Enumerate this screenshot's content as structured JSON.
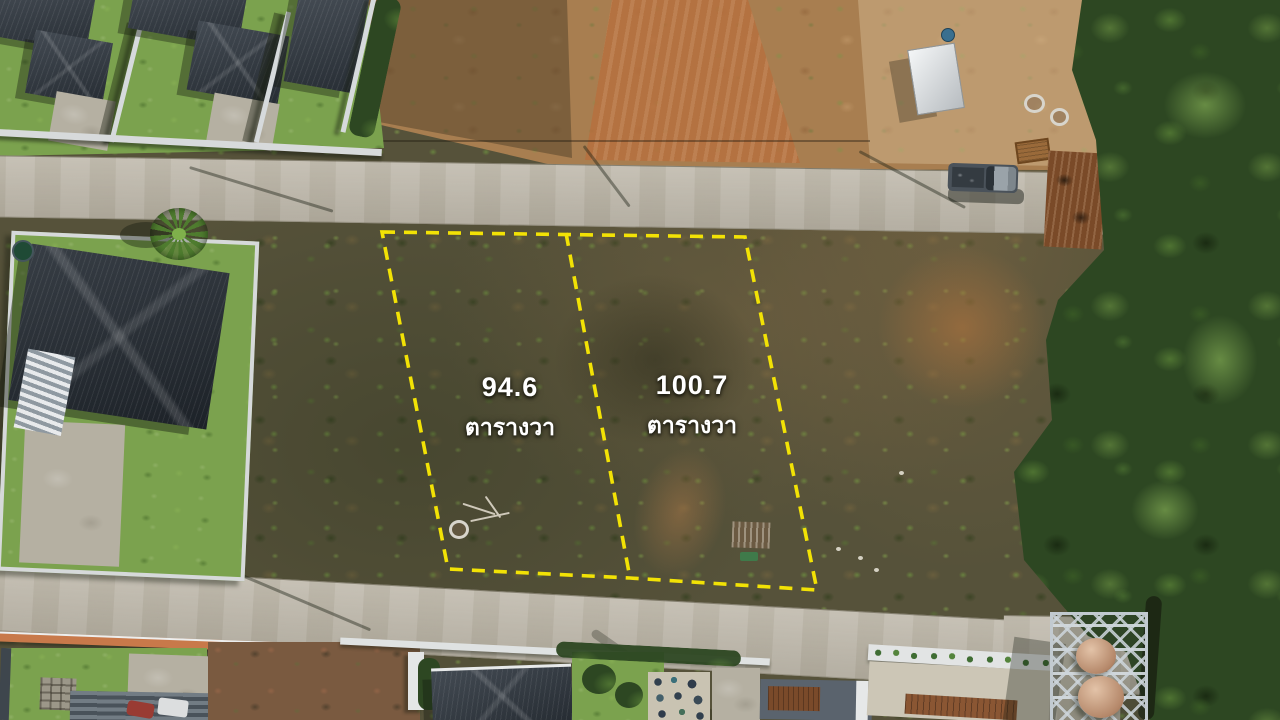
{
  "scene": {
    "type": "aerial-drone-photograph",
    "description": "Top-down drone photo of two adjacent vacant land plots outlined with yellow dashed survey lines, between two concrete roads, flanked by grey-roofed houses on the left and bottom, bare dirt at top and dense trees on the right",
    "plots": [
      {
        "id": "left-plot",
        "area_value": "94.6",
        "area_unit": "ตารางวา"
      },
      {
        "id": "right-plot",
        "area_value": "100.7",
        "area_unit": "ตารางวา"
      }
    ],
    "colors": {
      "boundary_yellow": "#f2e205",
      "label_text": "#ffffff",
      "road_concrete": "#bcb6a8",
      "bare_dirt": "#a87e50",
      "scrubland": "#57533a",
      "tree_canopy": "#2d4722",
      "roof_slate": "#343c45",
      "lawn_green": "#7ba24e"
    }
  }
}
